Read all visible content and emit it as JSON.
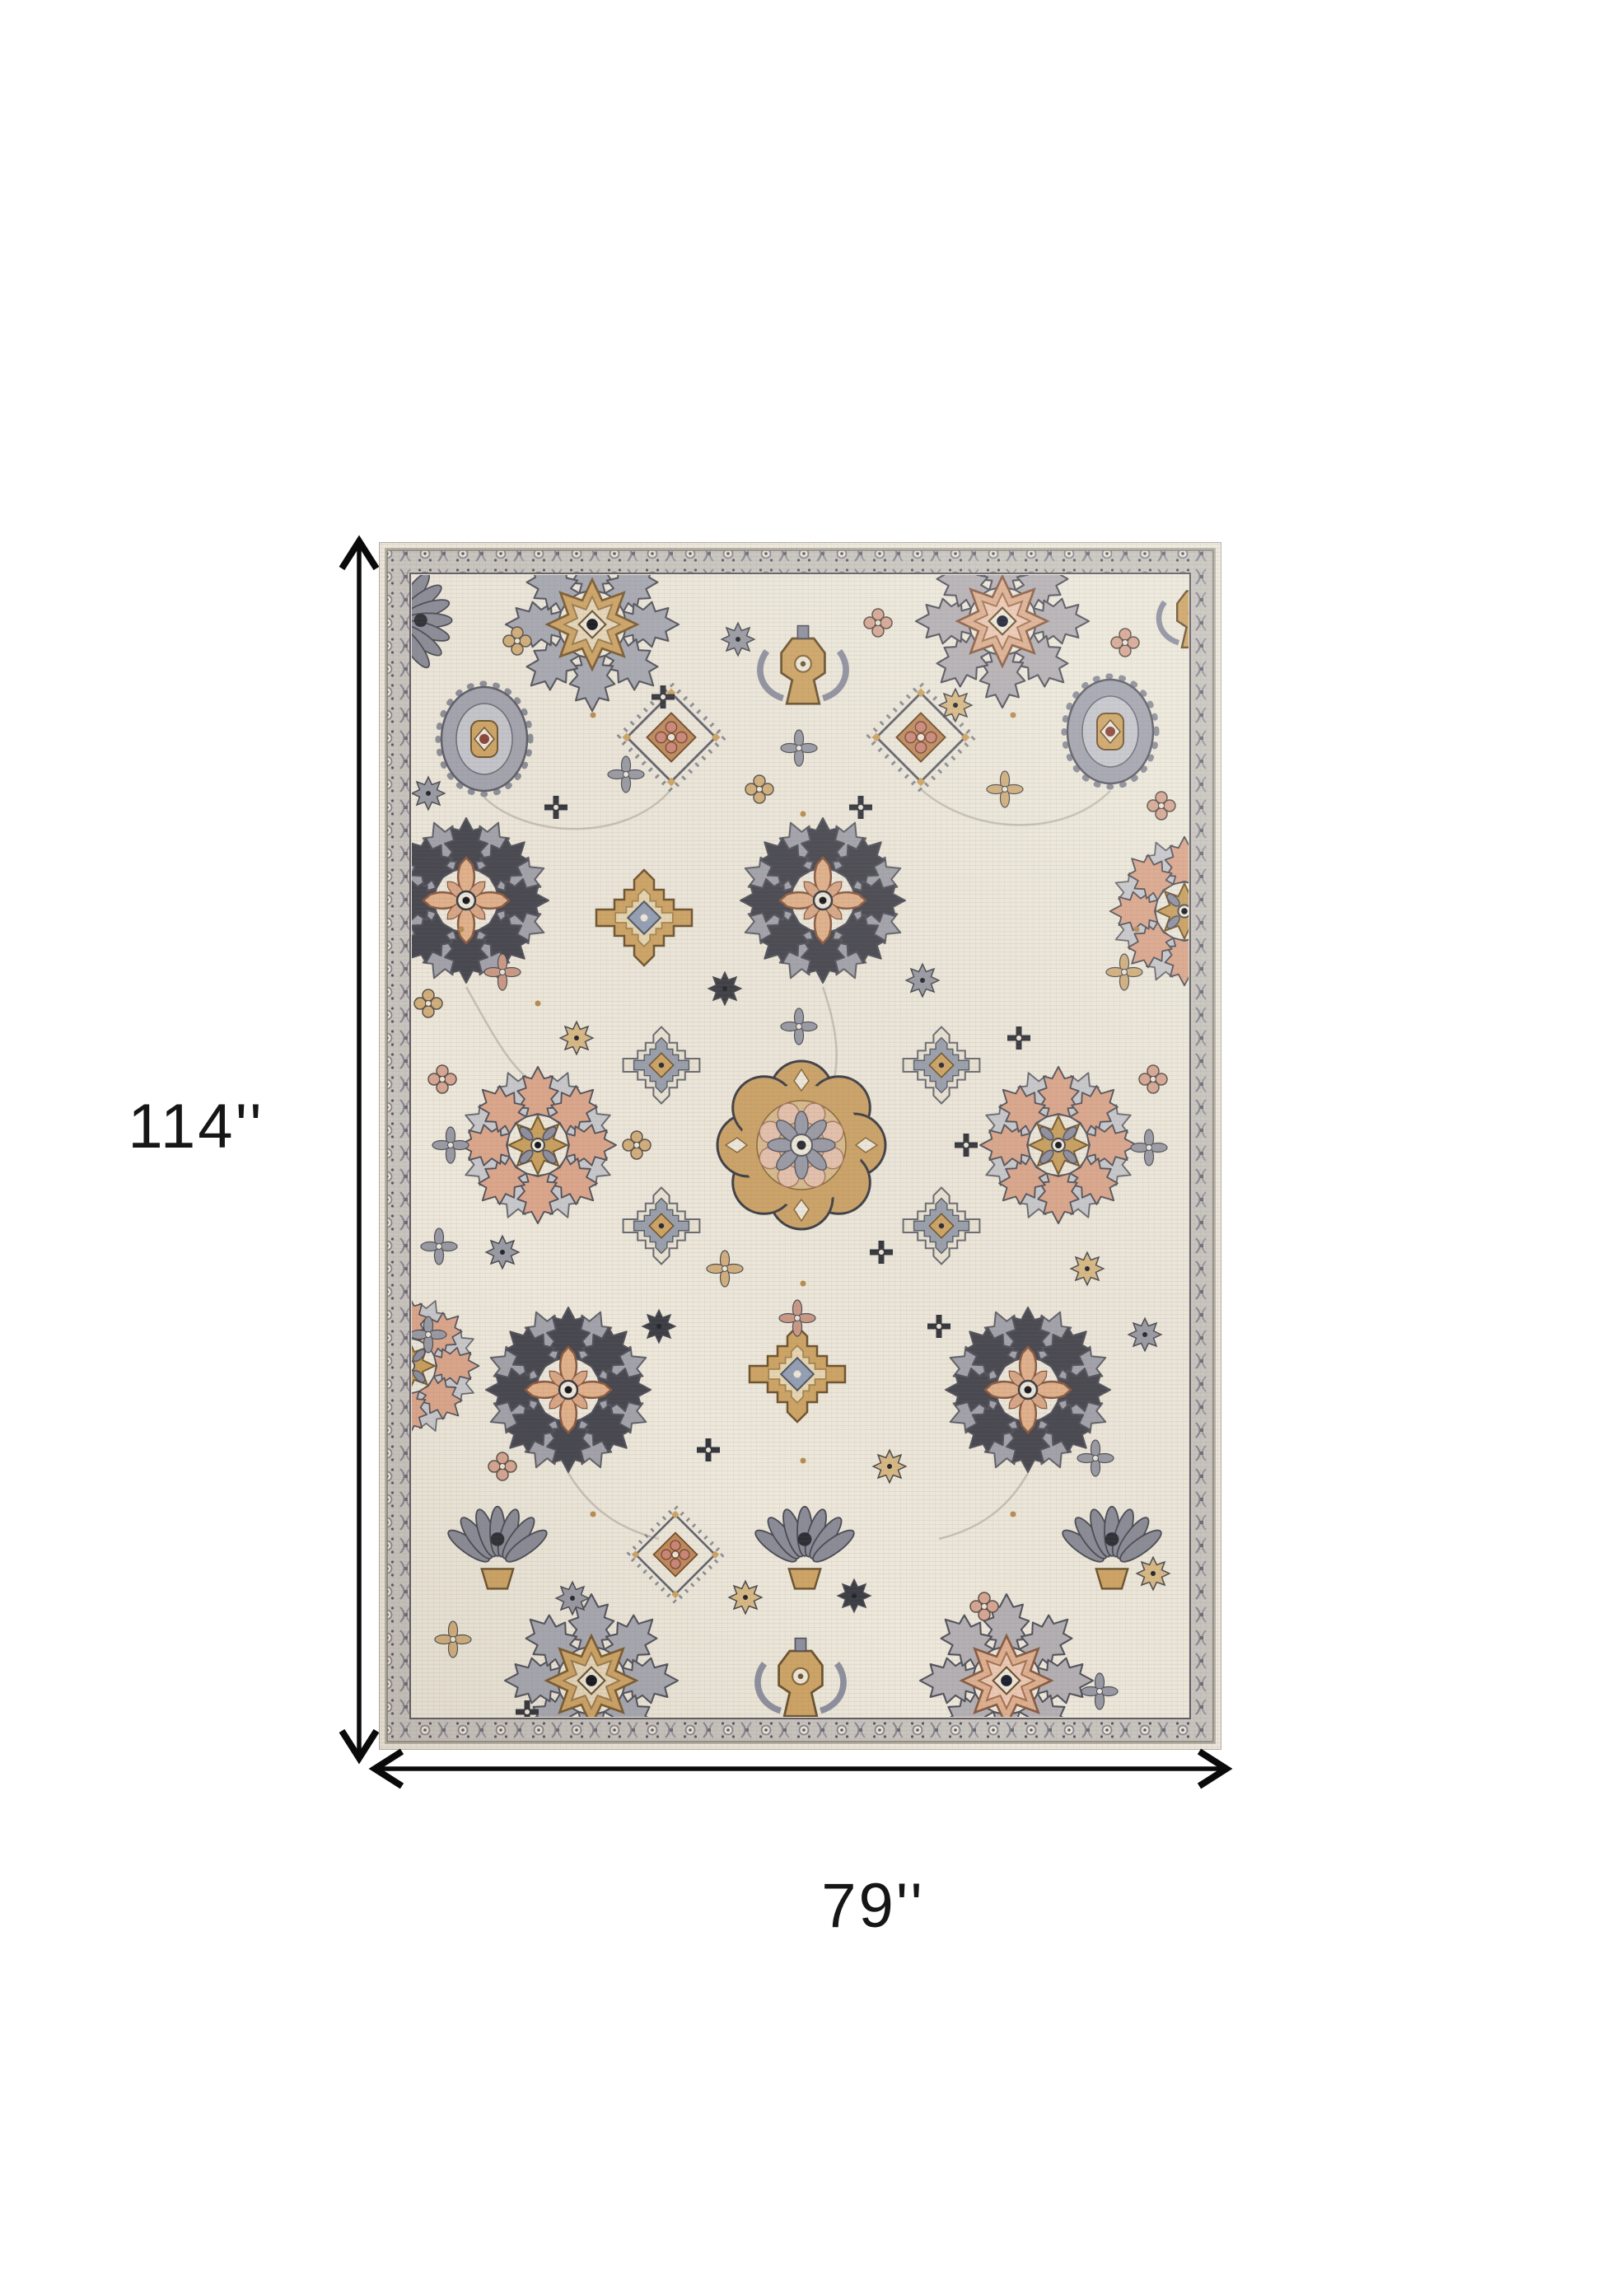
{
  "page": {
    "background_color": "#ffffff"
  },
  "diagram": {
    "height_label": "114''",
    "width_label": "79''",
    "arrow_color": "#0a0a0a",
    "label_color": "#161616"
  },
  "icons": {
    "vertical_arrow": "double-headed-vertical-arrow",
    "horizontal_arrow": "double-headed-horizontal-arrow"
  },
  "rug": {
    "name": "ivory-multicolor-oriental-area-rug",
    "palette": {
      "field": "#ede8db",
      "border_band": "#c9c5bf",
      "gold": "#cfa566",
      "gray": "#9a9ba6",
      "charcoal": "#45454e",
      "salmon": "#dca78c",
      "pink": "#d8a794",
      "ink": "#15161c"
    }
  }
}
